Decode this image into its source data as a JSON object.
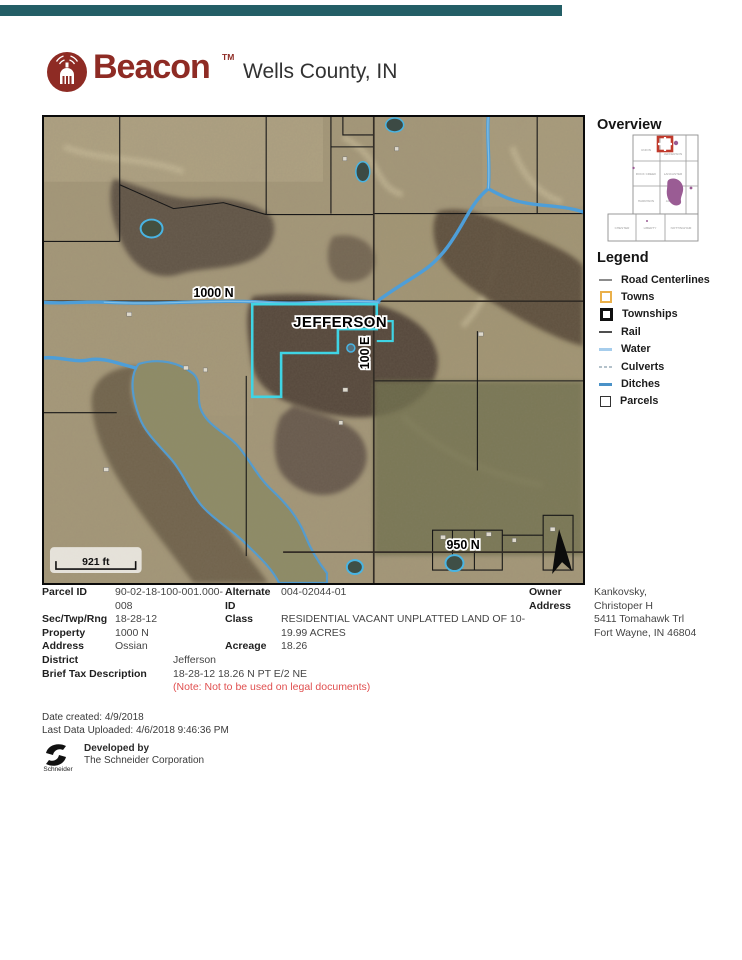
{
  "header": {
    "brand": "Beacon",
    "tm": "TM",
    "title": "Wells County, IN",
    "bar_color": "#235e66",
    "brand_color": "#8e2b24"
  },
  "overview": {
    "title": "Overview",
    "townships": [
      "UNION",
      "JEFFERSON",
      "ROCK CREEK",
      "LANCASTER",
      "HARRISON",
      "JACKSON",
      "CHESTER",
      "LIBERTY",
      "NOTTINGHAM"
    ],
    "marker_color": "#c0392b",
    "city_color": "#9a5c94"
  },
  "legend": {
    "title": "Legend",
    "items": [
      {
        "label": "Road Centerlines",
        "type": "line",
        "color": "#8c8c8c"
      },
      {
        "label": "Towns",
        "type": "square",
        "color": "#eab04a"
      },
      {
        "label": "Townships",
        "type": "square",
        "color": "#101010"
      },
      {
        "label": "Rail",
        "type": "line",
        "color": "#4f4f4f"
      },
      {
        "label": "Water",
        "type": "line",
        "color": "#a6cdec"
      },
      {
        "label": "Culverts",
        "type": "dashed-line",
        "color": "#b4c2cb"
      },
      {
        "label": "Ditches",
        "type": "line",
        "color": "#4a92c8"
      },
      {
        "label": "Parcels",
        "type": "square",
        "color": "#333333"
      }
    ]
  },
  "map": {
    "labels": {
      "road_1000n": "1000 N",
      "town": "JEFFERSON",
      "road_100e": "100 E",
      "road_950n": "950 N"
    },
    "scale_text": "921 ft",
    "selected_parcel_color": "#3fd4e4",
    "ditch_color": "#4e9ed8"
  },
  "details": {
    "parcel_id_label": "Parcel ID",
    "parcel_id": "90-02-18-100-001.000-\n008",
    "sec_label": "Sec/Twp/Rng",
    "sec": "18-28-12",
    "prop_label": "Property\nAddress",
    "prop": "1000 N\nOssian",
    "alt_label": "Alternate\nID",
    "alt": "004-02044-01",
    "class_label": "Class",
    "class": "RESIDENTIAL VACANT UNPLATTED LAND OF 10-\n19.99 ACRES",
    "acreage_label": "Acreage",
    "acreage": "18.26",
    "owner_label": "Owner\nAddress",
    "owner": "Kankovsky,\nChristoper H\n5411 Tomahawk Trl\nFort Wayne, IN 46804",
    "district_label": "District",
    "district": "Jefferson",
    "tax_label": "Brief Tax Description",
    "tax": "18-28-12 18.26 N PT E/2 NE",
    "note": "(Note: Not to be used on legal documents)"
  },
  "footer": {
    "date_created": "Date created: 4/9/2018",
    "last_uploaded": "Last Data Uploaded: 4/6/2018 9:46:36 PM",
    "developed_by": "Developed by",
    "company": "The Schneider Corporation",
    "schneider": "Schneider"
  }
}
